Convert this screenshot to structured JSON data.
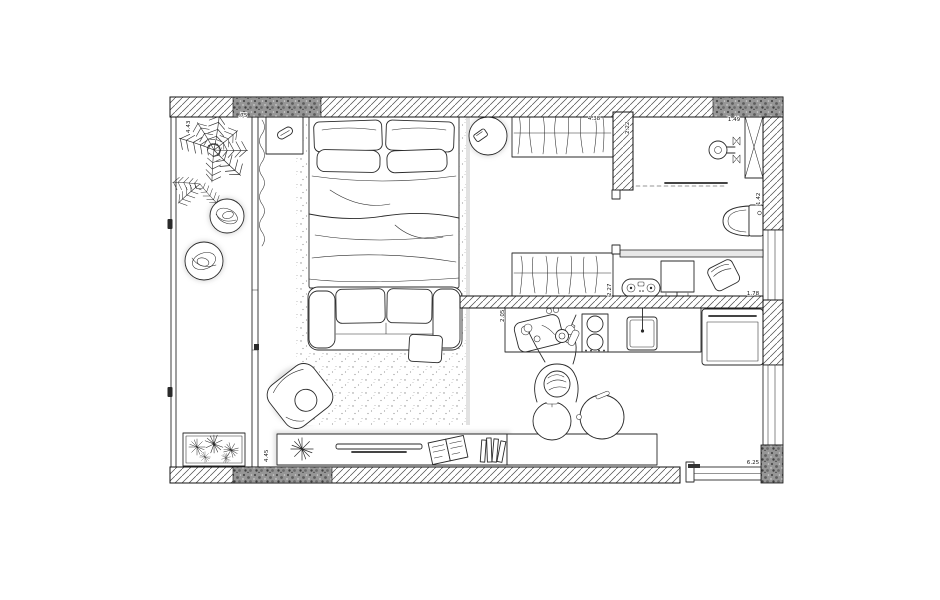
{
  "colors": {
    "ink": "#2a2a2a",
    "wall_speckle": "#969696",
    "paper": "#ffffff"
  },
  "floor_plan": {
    "dimensions": {
      "balcony_length": "4.43",
      "balcony_width": ".75",
      "wardrobe_width": "4.38",
      "bathroom_depth": "2.22",
      "shower_width": "1.49",
      "wc_depth": "1.42",
      "closet_depth": "2.27",
      "kitchen_depth": "2.05",
      "study_width": "1.78",
      "living_length": "4.45",
      "entry_width": "6.25"
    },
    "objects": [
      "balcony",
      "fern-plant",
      "log-stool",
      "planter-box",
      "curtain",
      "double-bed",
      "nightstand",
      "table-lamp",
      "area-rug",
      "sofa",
      "ottoman",
      "armchair",
      "media-console",
      "houseplant",
      "soundbar",
      "magazine",
      "books",
      "round-side-table",
      "phone",
      "wardrobe",
      "closet",
      "shower-head",
      "shower-column",
      "sliding-door",
      "toilet",
      "monitor-desk",
      "seat-cushion",
      "shelf-console",
      "kitchen-counter",
      "cutting-board",
      "knife",
      "cooktop",
      "sink",
      "oven",
      "person-cooking",
      "kitchen-island",
      "bar-stool",
      "entry-door"
    ]
  }
}
